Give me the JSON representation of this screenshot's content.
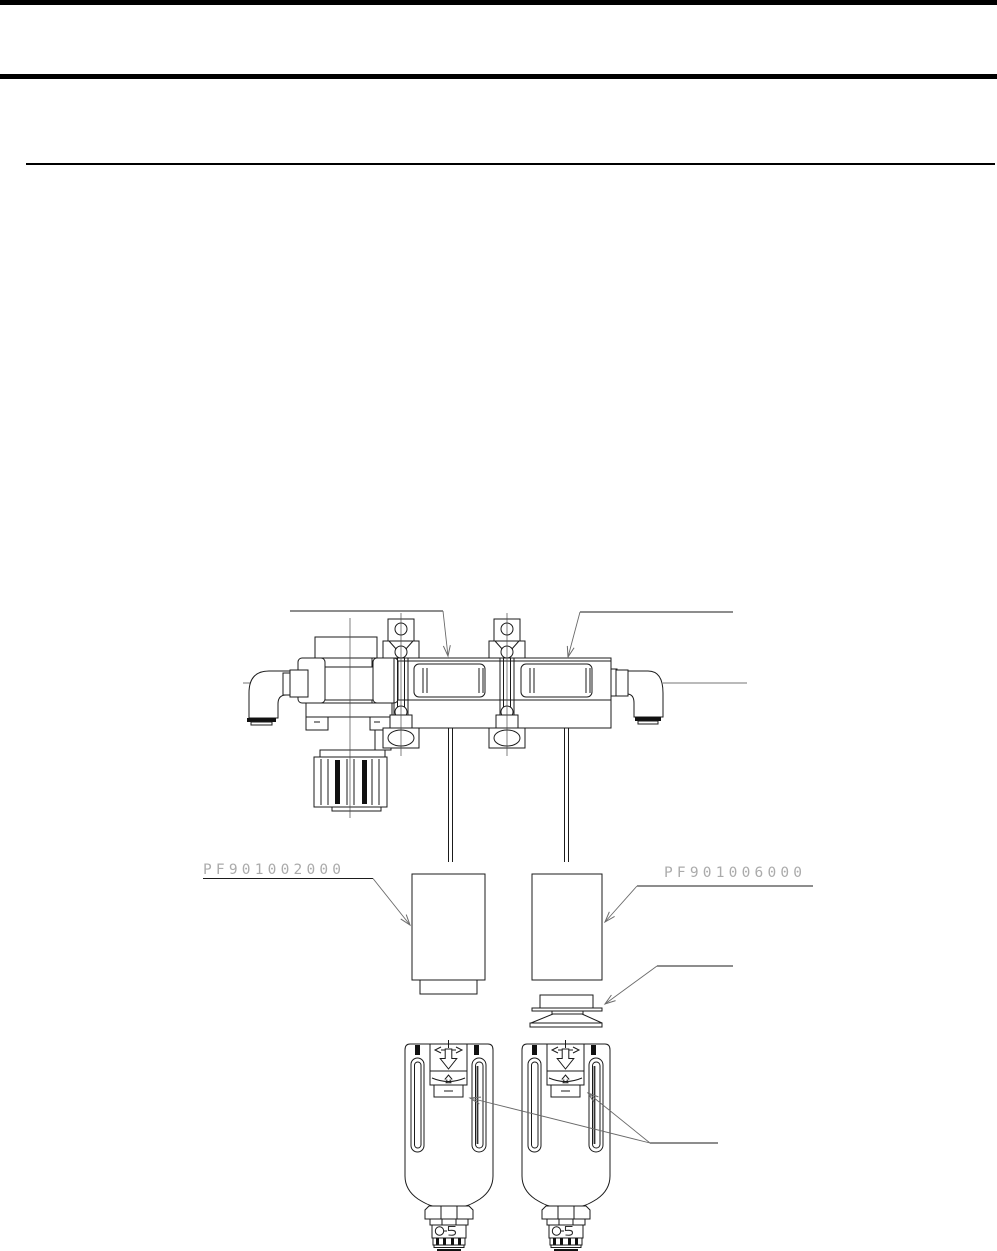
{
  "page": {
    "width": 997,
    "height": 1251,
    "background_color": "#ffffff",
    "rule_color": "#000000"
  },
  "diagram": {
    "line_color": "#1b1b1b",
    "leader_line_color": "#6a6a6a",
    "part_label_color": "#ababab",
    "labels": {
      "left_part_number": "PF901002000",
      "right_part_number": "PF901006000"
    }
  }
}
